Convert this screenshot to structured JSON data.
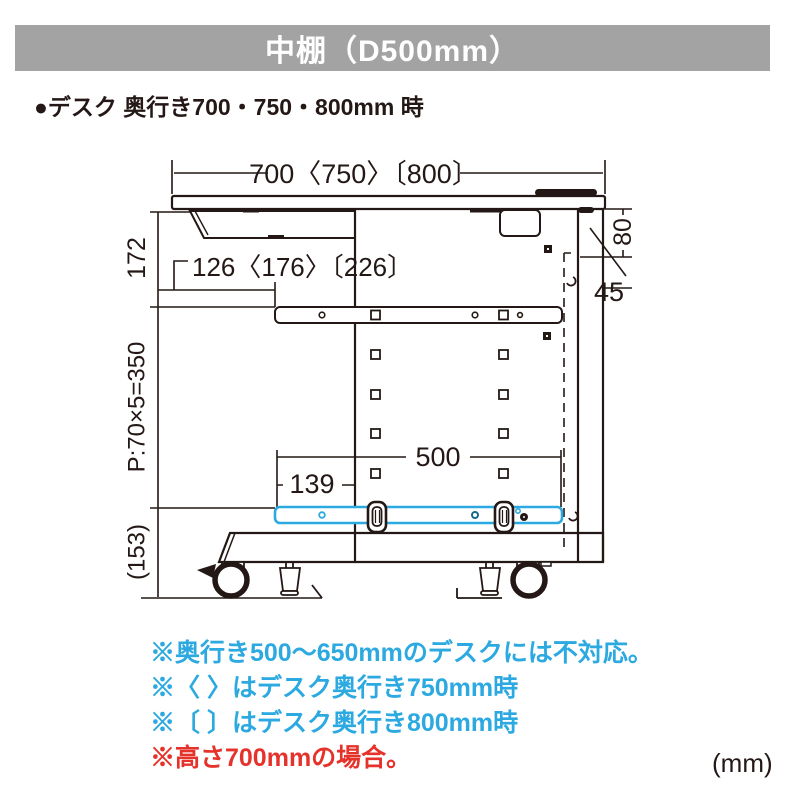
{
  "banner": {
    "title": "中棚（D500mm）",
    "bg_color": "#a3a3a3"
  },
  "heading": {
    "text": "●デスク 奥行き700・750・800mm 時"
  },
  "diagram": {
    "dims": {
      "top_width": "700〈750〉〔800〕",
      "tray_inset": "126〈176〉〔226〕",
      "upper_height": "172",
      "pitch": "P:70×5=350",
      "lower_height": "(153)",
      "rear_offset": "80",
      "hook_size": "45",
      "shelf_depth": "500",
      "shelf_front_gap": "139"
    },
    "colors": {
      "line": "#231815",
      "shelf_accent": "#2ba9e0"
    }
  },
  "notes": [
    {
      "text": "※奥行き500～650mmのデスクには不対応。",
      "color": "#2ba9e0"
    },
    {
      "text": "※〈 〉はデスク奥行き750mm時",
      "color": "#2ba9e0"
    },
    {
      "text": "※〔 〕はデスク奥行き800mm時",
      "color": "#2ba9e0"
    },
    {
      "text": "※高さ700mmの場合。",
      "color": "#e5332c"
    }
  ],
  "unit_label": "(mm)"
}
